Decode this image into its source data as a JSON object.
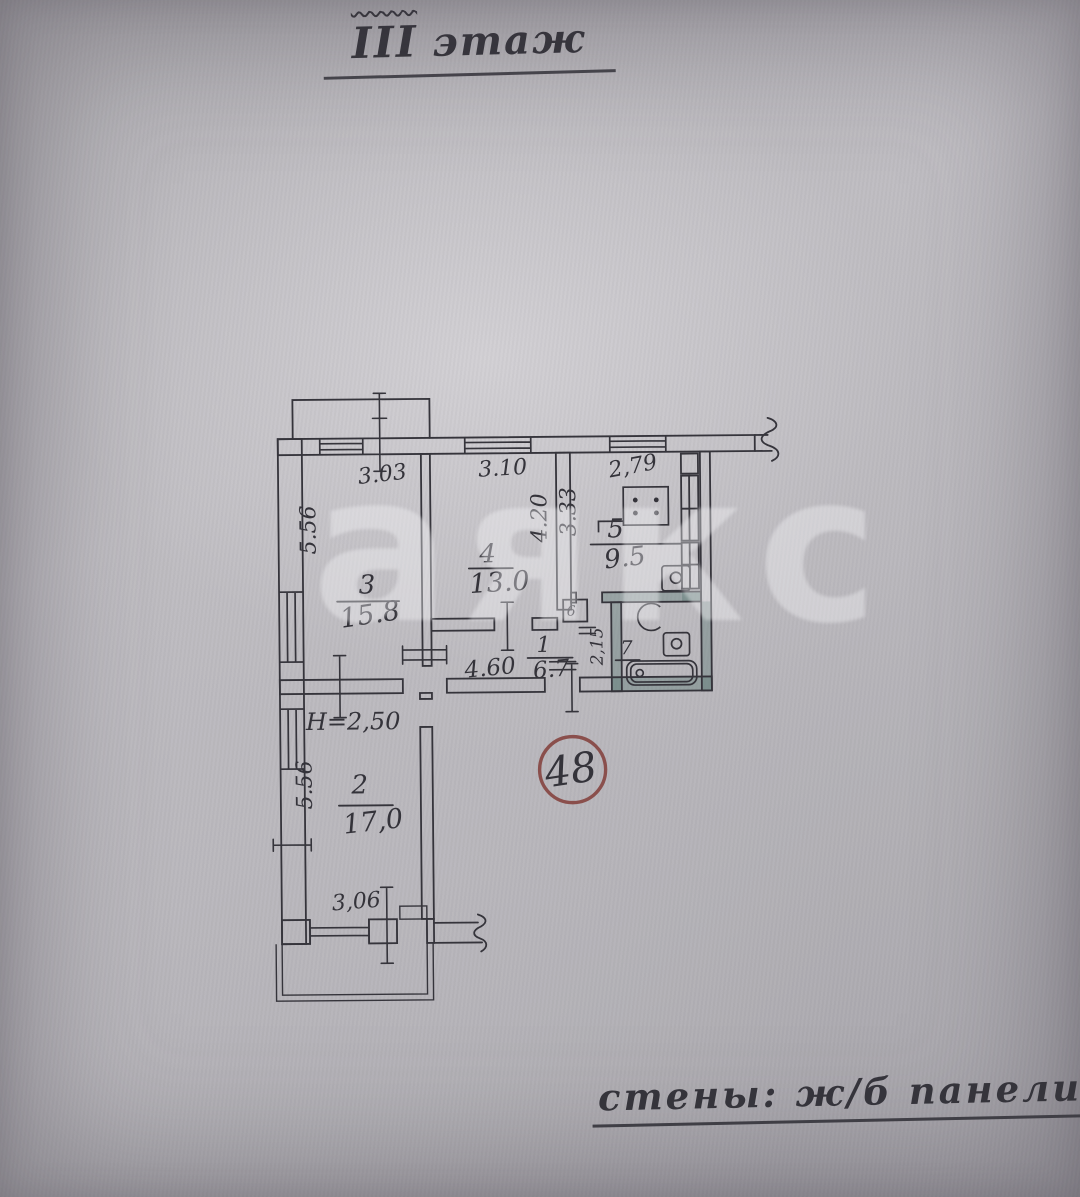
{
  "document": {
    "title": {
      "roman": "III",
      "word": "этаж"
    },
    "stamp_number": "48",
    "walls_note": "стены: ж/б панели",
    "watermark": "аякс"
  },
  "plan": {
    "height_note": "Н=2,50",
    "rooms": [
      {
        "number": "1",
        "area": "6.7"
      },
      {
        "number": "2",
        "area": "17,0"
      },
      {
        "number": "3",
        "area": "15.8"
      },
      {
        "number": "4",
        "area": "13.0"
      },
      {
        "number": "5",
        "area": "9.5"
      },
      {
        "number": "6",
        "area": ""
      },
      {
        "number": "7",
        "area": ""
      }
    ],
    "dimensions": {
      "room3_width": "3.03",
      "room4_width": "3.10",
      "kitchen_width": "2,79",
      "room3_depth": "5.56",
      "room4_depth": "4.20",
      "kitchen_depth": "3.33",
      "hallway_length": "4.60",
      "room2_depth": "5.56",
      "room2_width": "3,06",
      "bathroom_width": "2,15"
    }
  },
  "colors": {
    "ink": "#34333a",
    "stamp_red": "#8a4f4c",
    "wet_wall_tint": "#56766f",
    "paper": "#b9b7bb"
  }
}
